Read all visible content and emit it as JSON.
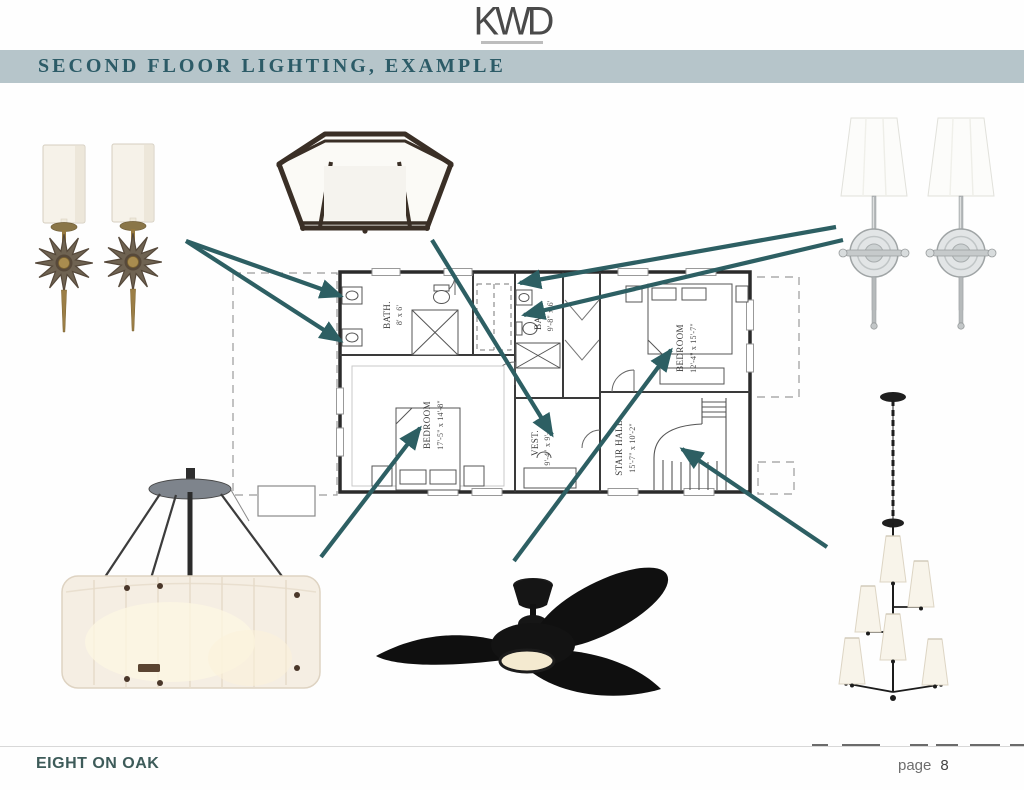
{
  "header": {
    "logo_text": "KWD",
    "title": "SECOND FLOOR LIGHTING, EXAMPLE"
  },
  "footer": {
    "project_name": "EIGHT ON OAK",
    "page_label": "page",
    "page_number": "8"
  },
  "colors": {
    "banner": "#B6C5CA",
    "title_text": "#2C5B67",
    "arrow": "#2D5F63",
    "footer_text": "#3D5B59"
  },
  "plan": {
    "rooms": [
      {
        "id": "bath-left",
        "label": "BATH.",
        "dims": "8' x 6'"
      },
      {
        "id": "bath-right",
        "label": "BATH.",
        "dims": "9'-8\" x 6'"
      },
      {
        "id": "bedroom-left",
        "label": "BEDROOM",
        "dims": "17'-5\" x 14'-8\""
      },
      {
        "id": "bedroom-right",
        "label": "BEDROOM",
        "dims": "12'-4\" x 15'-7\""
      },
      {
        "id": "vestibule",
        "label": "VEST.",
        "dims": "9'-4\" x 9'-11\""
      },
      {
        "id": "stair-hall",
        "label": "STAIR HALL",
        "dims": "15'-7\" x 10'-2\""
      }
    ]
  },
  "fixtures": [
    {
      "id": "sconce-pair-antique-brass",
      "desc": "pair of antique starburst sconces with white cylinder shades"
    },
    {
      "id": "hexagonal-flush-mount",
      "desc": "bronze hexagonal flush mount with frosted glass panels"
    },
    {
      "id": "sconce-pair-polished-nickel",
      "desc": "pair of polished nickel sconces with tapered white shades"
    },
    {
      "id": "alabaster-drum-pendant",
      "desc": "alabaster drum pendant with bronze hardware"
    },
    {
      "id": "black-ceiling-fan",
      "desc": "black three-blade ceiling fan with integrated light"
    },
    {
      "id": "tiered-vertical-chandelier",
      "desc": "black tiered vertical chandelier with linen shades"
    }
  ],
  "annotations": {
    "arrow_color": "#2D5F63",
    "arrows": [
      {
        "from": "sconce-pair-antique-brass",
        "to": "bath-left-sink-top",
        "x1": 186,
        "y1": 241,
        "x2": 341,
        "y2": 296
      },
      {
        "from": "sconce-pair-antique-brass",
        "to": "bath-left-sink-bottom",
        "x1": 186,
        "y1": 241,
        "x2": 341,
        "y2": 341
      },
      {
        "from": "hexagonal-flush-mount",
        "to": "vestibule",
        "x1": 432,
        "y1": 240,
        "x2": 552,
        "y2": 435
      },
      {
        "from": "sconce-pair-polished-nickel",
        "to": "bath-right-top",
        "x1": 836,
        "y1": 227,
        "x2": 520,
        "y2": 283
      },
      {
        "from": "sconce-pair-polished-nickel",
        "to": "bath-right-sink",
        "x1": 843,
        "y1": 240,
        "x2": 524,
        "y2": 315
      },
      {
        "from": "alabaster-drum-pendant",
        "to": "bedroom-left",
        "x1": 321,
        "y1": 557,
        "x2": 420,
        "y2": 428
      },
      {
        "from": "black-ceiling-fan",
        "to": "bedroom-right",
        "x1": 514,
        "y1": 561,
        "x2": 671,
        "y2": 350
      },
      {
        "from": "tiered-vertical-chandelier",
        "to": "stair-hall",
        "x1": 827,
        "y1": 547,
        "x2": 682,
        "y2": 449
      }
    ]
  }
}
